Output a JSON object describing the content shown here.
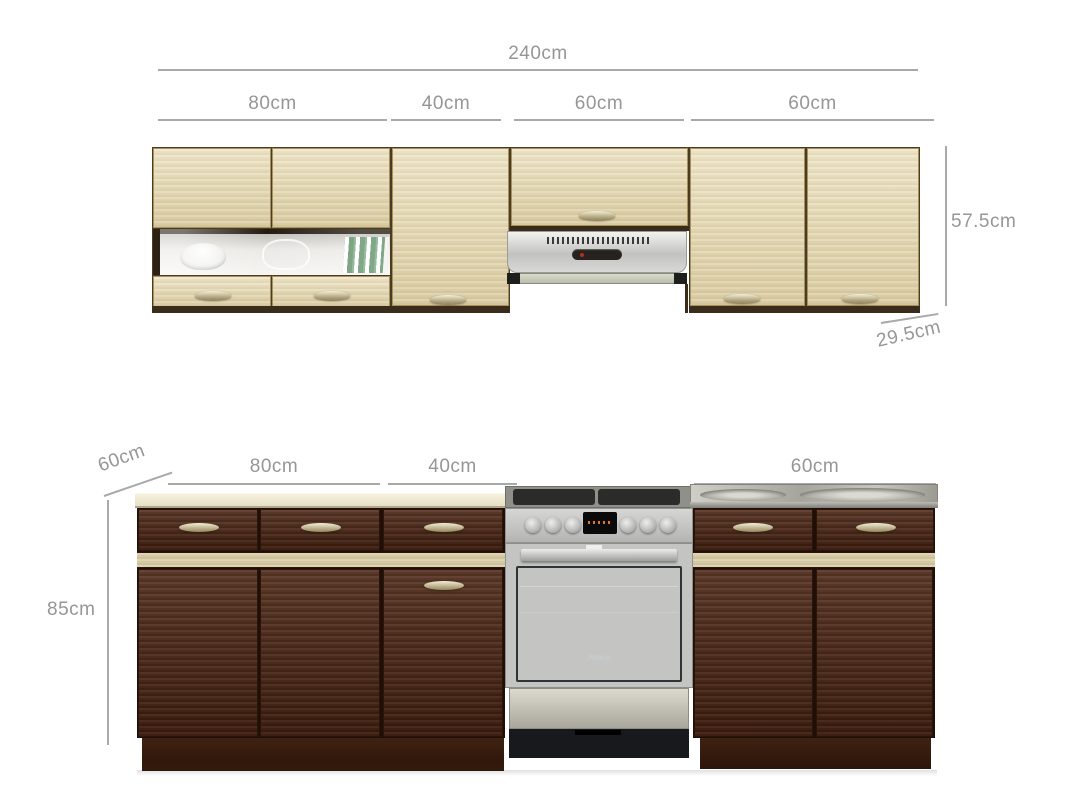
{
  "annotations": {
    "total_width": "240cm",
    "upper_segments": [
      "80cm",
      "40cm",
      "60cm",
      "60cm"
    ],
    "upper_height": "57.5cm",
    "upper_depth": "29.5cm",
    "lower_depth": "60cm",
    "lower_segments": [
      "80cm",
      "40cm",
      "60cm"
    ],
    "lower_height": "85cm"
  },
  "cooker": {
    "brand": "Amica"
  },
  "colors": {
    "dimension_text": "#969696",
    "dimension_line": "#a9a9a9",
    "upper_cabinet_wood": "#e5d9b4",
    "base_cabinet_wood": "#4b2717",
    "accent_stripe": "#d5c9a5",
    "countertop": "#eae3cc",
    "stainless": "#c6c6c4",
    "oven_glass": "#5d7282"
  }
}
